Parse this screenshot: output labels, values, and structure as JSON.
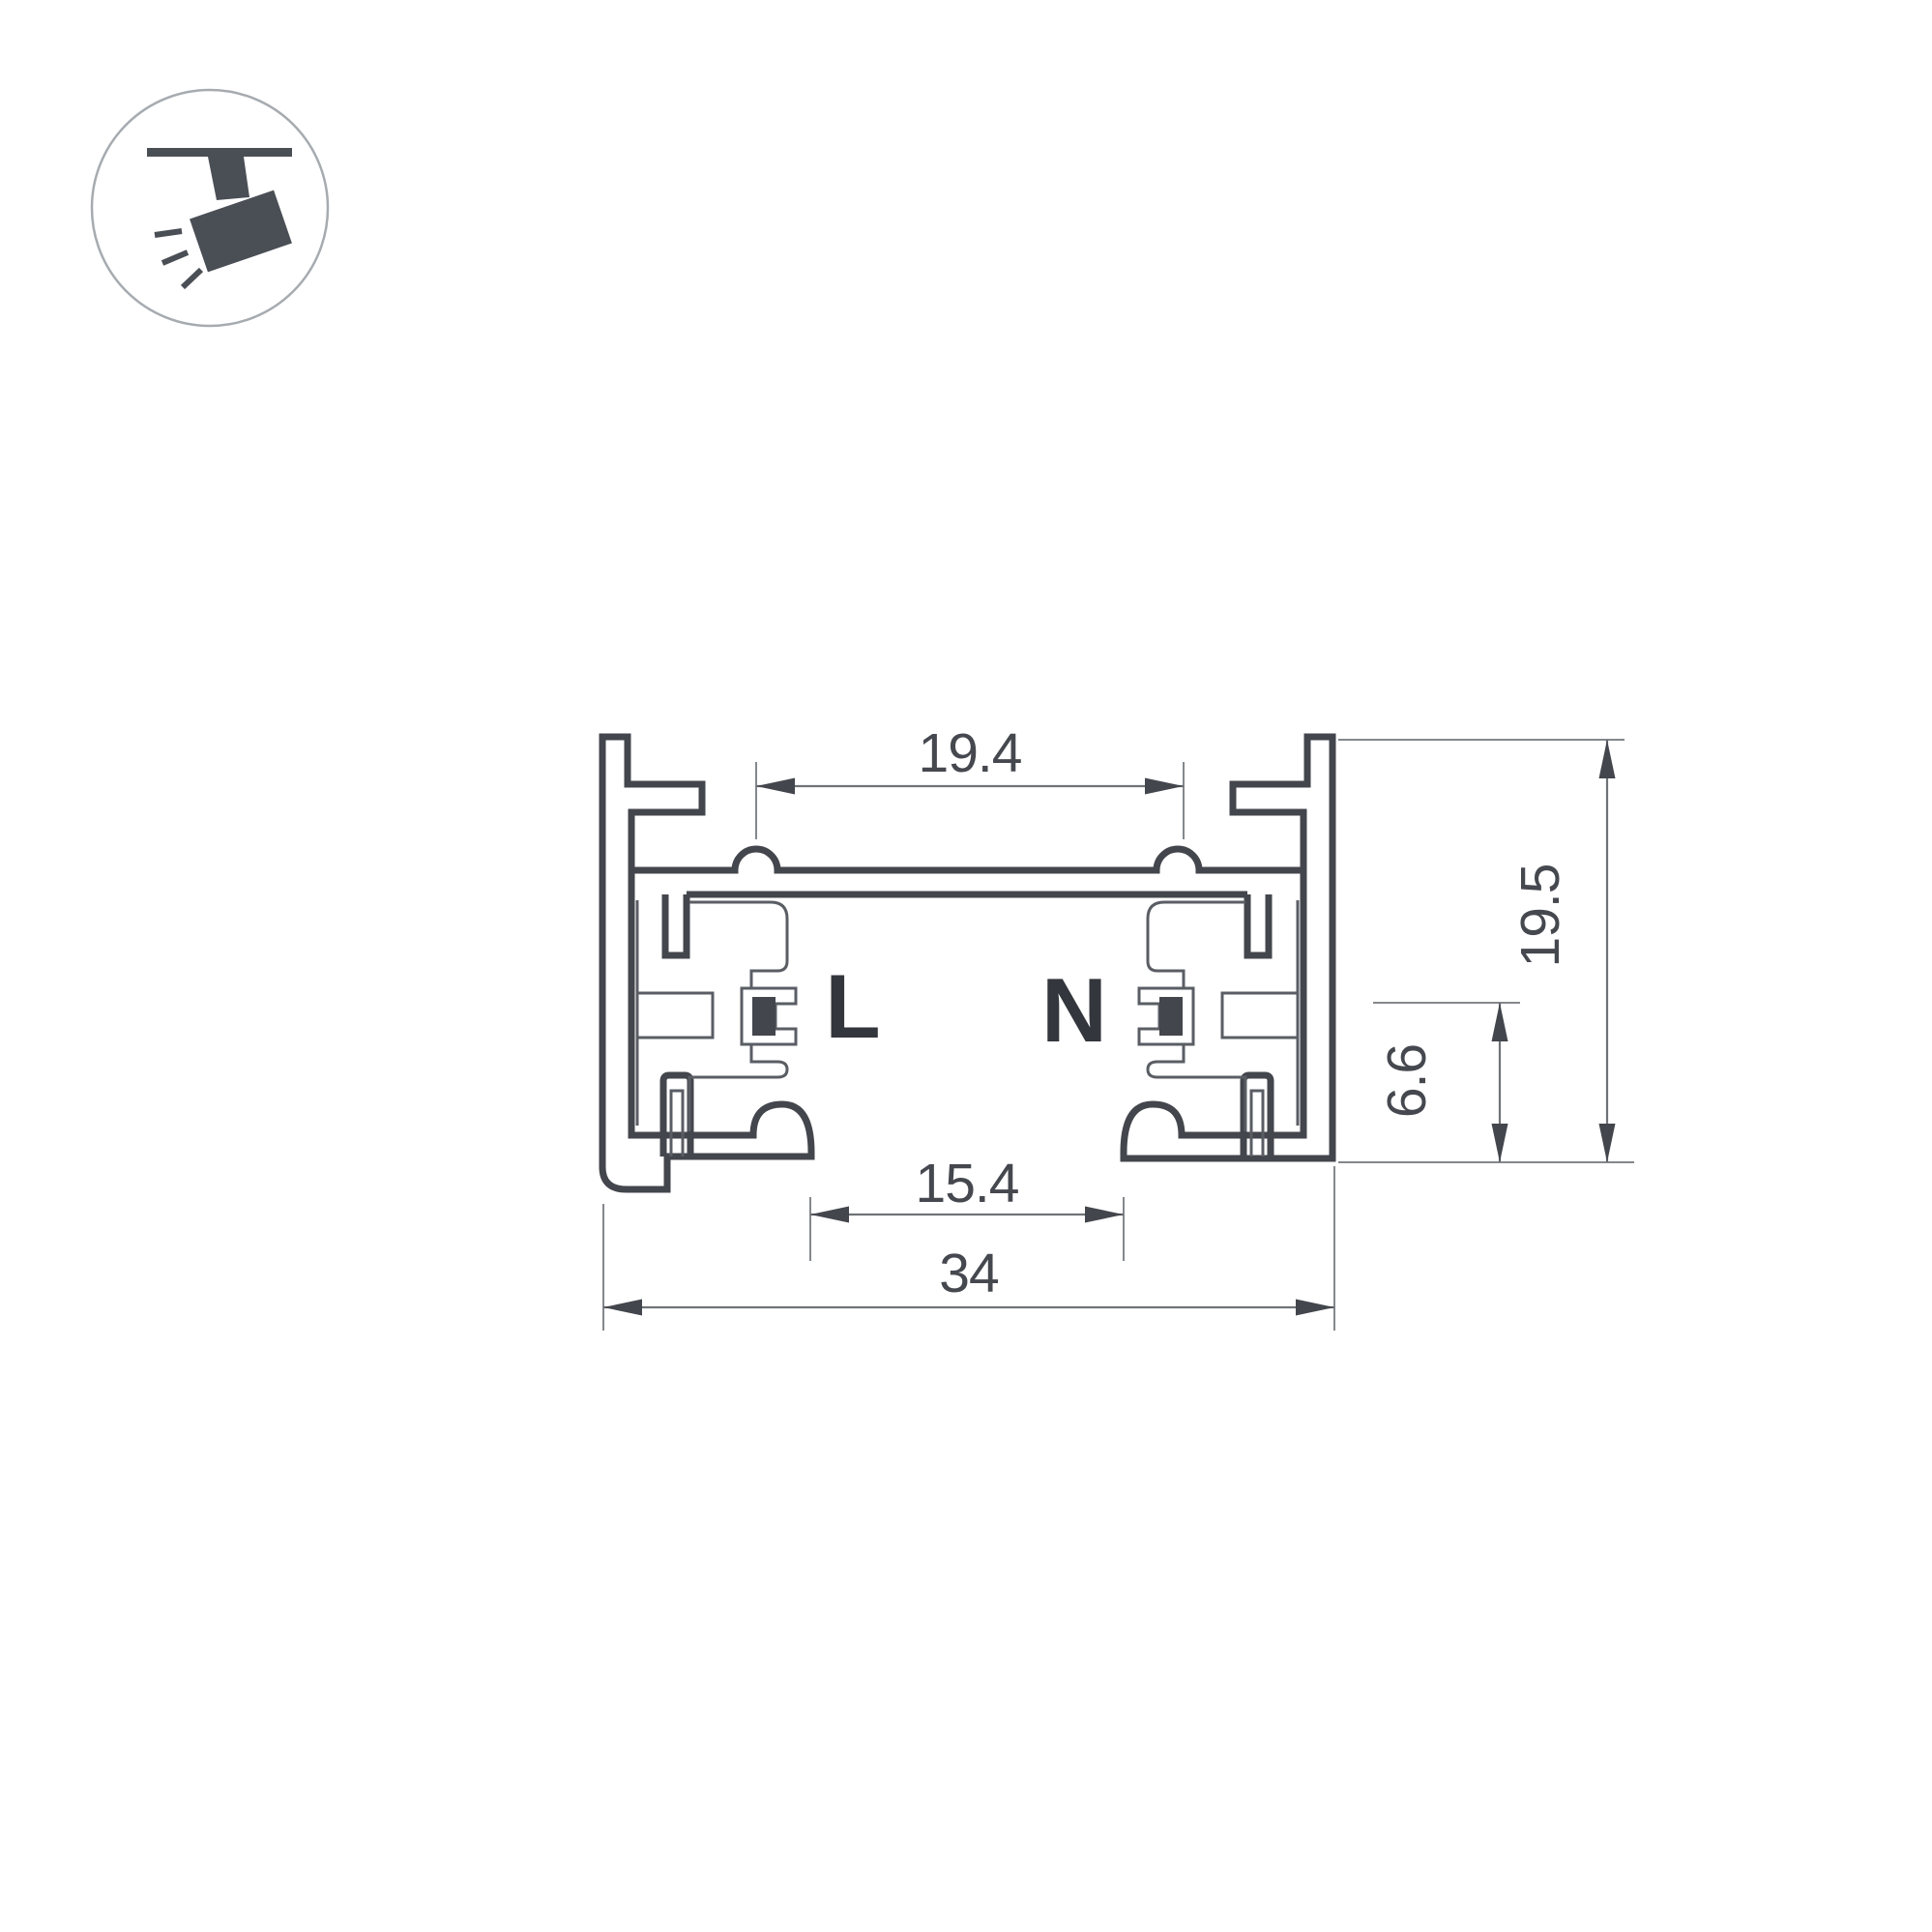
{
  "icon": {
    "name": "track-spotlight-icon",
    "description": "ceiling track with angled spotlight head and light rays"
  },
  "conductors": {
    "live_label": "L",
    "neutral_label": "N"
  },
  "dimensions": {
    "top_groove_width": "19.4",
    "bottom_opening_width": "15.4",
    "overall_width": "34",
    "overall_height": "19.5",
    "contact_opening_height": "6.6"
  },
  "colors": {
    "profile_line": "#43464c",
    "insulator_line": "#5a5e64",
    "dimension_line": "#6f7378",
    "text": "#45484e",
    "icon_circle_outline": "#a6abb0",
    "background": "#ffffff"
  }
}
